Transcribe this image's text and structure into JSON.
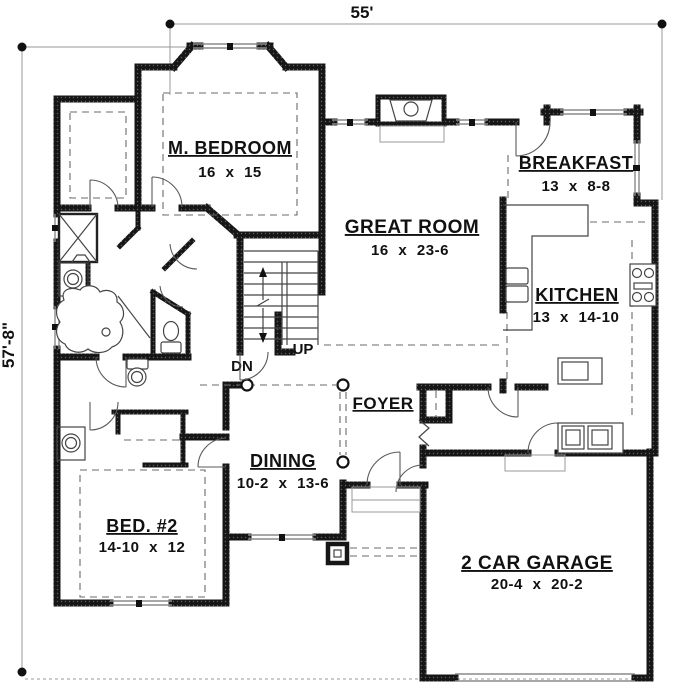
{
  "dimensions": {
    "top": "55'",
    "left": "57'-8\""
  },
  "rooms": {
    "m_bedroom": {
      "name": "M. BEDROOM",
      "size": "16 x 15"
    },
    "breakfast": {
      "name": "BREAKFAST",
      "size": "13 x 8-8"
    },
    "great_room": {
      "name": "GREAT ROOM",
      "size": "16 x 23-6"
    },
    "kitchen": {
      "name": "KITCHEN",
      "size": "13 x 14-10"
    },
    "foyer": {
      "name": "FOYER"
    },
    "dining": {
      "name": "DINING",
      "size": "10-2 x 13-6"
    },
    "bed2": {
      "name": "BED. #2",
      "size": "14-10 x 12"
    },
    "garage": {
      "name": "2 CAR GARAGE",
      "size": "20-4 x 20-2"
    }
  },
  "stairs": {
    "down": "DN",
    "up": "UP"
  },
  "colors": {
    "wall": "#161616",
    "line": "#444444",
    "background": "#ffffff"
  }
}
